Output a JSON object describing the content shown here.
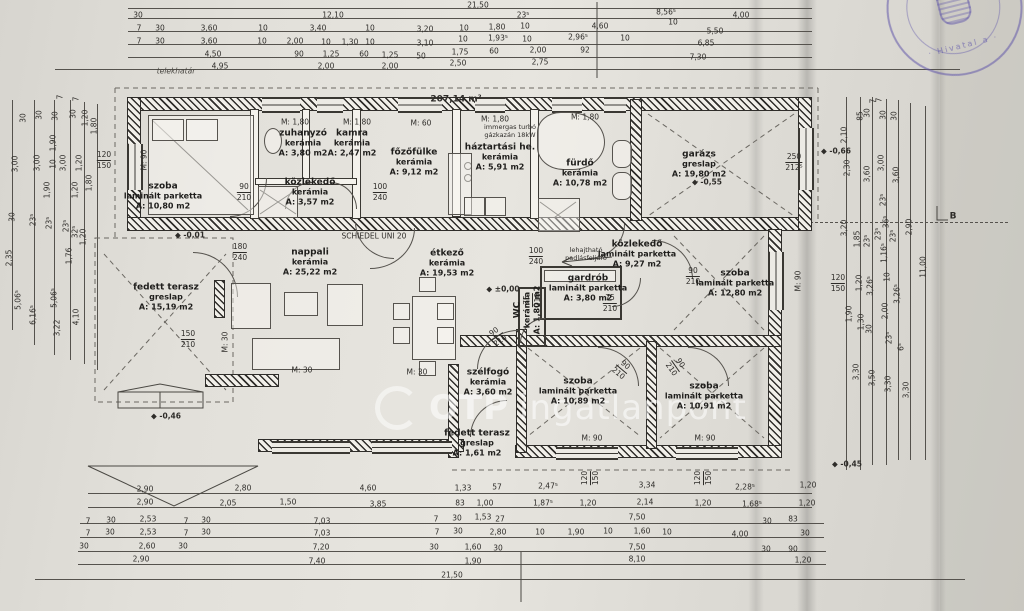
{
  "watermark": {
    "prefix": "OTP",
    "text": "ingatlanpont"
  },
  "stamp": {
    "text": "· Hivatal a ·"
  },
  "rooms": [
    {
      "name": "szoba",
      "material": "laminált parketta",
      "area": "A: 10,80 m2",
      "x": 163,
      "y": 196
    },
    {
      "name": "zuhanyzó",
      "material": "kerámia",
      "area": "A: 3,80 m2",
      "x": 303,
      "y": 143
    },
    {
      "name": "kamra",
      "material": "kerámia",
      "area": "A: 2,47 m2",
      "x": 352,
      "y": 143
    },
    {
      "name": "főzőfülke",
      "material": "kerámia",
      "area": "A: 9,12 m2",
      "x": 414,
      "y": 162
    },
    {
      "name": "háztartási he.",
      "material": "kerámia",
      "area": "A: 5,91 m2",
      "x": 500,
      "y": 157
    },
    {
      "name": "fürdő",
      "material": "kerámia",
      "area": "A: 10,78 m2",
      "x": 580,
      "y": 173
    },
    {
      "name": "garázs",
      "material": "greslap",
      "area": "A: 19,80 m2",
      "x": 699,
      "y": 164
    },
    {
      "name": "közlekedő",
      "material": "kerámia",
      "area": "A: 3,57 m2",
      "x": 310,
      "y": 192
    },
    {
      "name": "nappali",
      "material": "kerámia",
      "area": "A: 25,22 m2",
      "x": 310,
      "y": 262
    },
    {
      "name": "fedett terasz",
      "material": "greslap",
      "area": "A: 15,19 m2",
      "x": 166,
      "y": 297
    },
    {
      "name": "étkező",
      "material": "kerámia",
      "area": "A: 19,53 m2",
      "x": 447,
      "y": 263
    },
    {
      "name": "közlekedő",
      "material": "laminált parketta",
      "area": "A: 9,27 m2",
      "x": 637,
      "y": 254
    },
    {
      "name": "gardrób",
      "material": "laminált parketta",
      "area": "A: 3,80 m2",
      "x": 588,
      "y": 288
    },
    {
      "name": "WC",
      "material": "kerámia",
      "area": "A: 1,80 m2",
      "x": 527,
      "y": 310,
      "r": -90
    },
    {
      "name": "szoba",
      "material": "laminált parketta",
      "area": "A: 12,80 m2",
      "x": 735,
      "y": 283
    },
    {
      "name": "szoba",
      "material": "laminált parketta",
      "area": "A: 10,89 m2",
      "x": 578,
      "y": 391
    },
    {
      "name": "szoba",
      "material": "laminált parketta",
      "area": "A: 10,91 m2",
      "x": 704,
      "y": 396
    },
    {
      "name": "szélfogó",
      "material": "kerámia",
      "area": "A: 3,60 m2",
      "x": 488,
      "y": 382
    },
    {
      "name": "fedett terasz",
      "material": "greslap",
      "area": "A: 1,61 m2",
      "x": 477,
      "y": 443
    }
  ],
  "labels": [
    {
      "t": "21,50",
      "x": 478,
      "y": 5
    },
    {
      "t": "30",
      "x": 138,
      "y": 15
    },
    {
      "t": "12,10",
      "x": 333,
      "y": 15
    },
    {
      "t": "23⁵",
      "x": 523,
      "y": 15
    },
    {
      "t": "8,56⁵",
      "x": 666,
      "y": 12
    },
    {
      "t": "4,00",
      "x": 741,
      "y": 15
    },
    {
      "t": "7",
      "x": 139,
      "y": 28
    },
    {
      "t": "30",
      "x": 160,
      "y": 28
    },
    {
      "t": "3,60",
      "x": 209,
      "y": 28
    },
    {
      "t": "10",
      "x": 263,
      "y": 28
    },
    {
      "t": "3,40",
      "x": 318,
      "y": 28
    },
    {
      "t": "10",
      "x": 370,
      "y": 28
    },
    {
      "t": "3,20",
      "x": 425,
      "y": 29
    },
    {
      "t": "10",
      "x": 464,
      "y": 28
    },
    {
      "t": "1,80",
      "x": 497,
      "y": 27
    },
    {
      "t": "10",
      "x": 525,
      "y": 26
    },
    {
      "t": "4,60",
      "x": 600,
      "y": 26
    },
    {
      "t": "10",
      "x": 673,
      "y": 22
    },
    {
      "t": "5,50",
      "x": 715,
      "y": 31
    },
    {
      "t": "7",
      "x": 139,
      "y": 41
    },
    {
      "t": "30",
      "x": 160,
      "y": 41
    },
    {
      "t": "3,60",
      "x": 209,
      "y": 41
    },
    {
      "t": "10",
      "x": 262,
      "y": 41
    },
    {
      "t": "2,00",
      "x": 295,
      "y": 41
    },
    {
      "t": "10",
      "x": 326,
      "y": 42
    },
    {
      "t": "1,30",
      "x": 350,
      "y": 42
    },
    {
      "t": "10",
      "x": 370,
      "y": 42
    },
    {
      "t": "3,10",
      "x": 425,
      "y": 43
    },
    {
      "t": "10",
      "x": 463,
      "y": 39
    },
    {
      "t": "1,93⁵",
      "x": 498,
      "y": 38
    },
    {
      "t": "10",
      "x": 527,
      "y": 39
    },
    {
      "t": "2,96⁵",
      "x": 578,
      "y": 37
    },
    {
      "t": "10",
      "x": 625,
      "y": 38
    },
    {
      "t": "6,85",
      "x": 706,
      "y": 43
    },
    {
      "t": "4,50",
      "x": 213,
      "y": 54
    },
    {
      "t": "90",
      "x": 299,
      "y": 54
    },
    {
      "t": "1,25",
      "x": 331,
      "y": 54
    },
    {
      "t": "60",
      "x": 364,
      "y": 54
    },
    {
      "t": "1,25",
      "x": 390,
      "y": 55
    },
    {
      "t": "50",
      "x": 421,
      "y": 56
    },
    {
      "t": "1,75",
      "x": 460,
      "y": 52
    },
    {
      "t": "60",
      "x": 494,
      "y": 51
    },
    {
      "t": "2,00",
      "x": 538,
      "y": 50
    },
    {
      "t": "92",
      "x": 585,
      "y": 50
    },
    {
      "t": "7,30",
      "x": 698,
      "y": 57
    },
    {
      "t": "4,95",
      "x": 220,
      "y": 66
    },
    {
      "t": "2,00",
      "x": 326,
      "y": 66
    },
    {
      "t": "2,00",
      "x": 390,
      "y": 66
    },
    {
      "t": "2,50",
      "x": 458,
      "y": 63
    },
    {
      "t": "2,75",
      "x": 540,
      "y": 62
    },
    {
      "t": "telekhatár",
      "x": 176,
      "y": 71,
      "c": "it"
    },
    {
      "t": "207,14 m²",
      "x": 456,
      "y": 100,
      "c": "b"
    },
    {
      "t": "SCHIEDEL UNI 20",
      "x": 374,
      "y": 236
    },
    {
      "t": "immergas turbó",
      "x": 510,
      "y": 127,
      "c": "sm"
    },
    {
      "t": "gázkazán 18kW",
      "x": 510,
      "y": 135,
      "c": "sm"
    },
    {
      "t": "lehajtható",
      "x": 586,
      "y": 250,
      "c": "sm"
    },
    {
      "t": "padlásfeljáró",
      "x": 586,
      "y": 258,
      "c": "sm"
    },
    {
      "t": "B",
      "x": 953,
      "y": 217,
      "c": "b"
    },
    {
      "t": "±0,00",
      "x": 503,
      "y": 289,
      "c": "lvl"
    },
    {
      "t": "-0,01",
      "x": 190,
      "y": 235,
      "c": "lvl"
    },
    {
      "t": "-0,46",
      "x": 166,
      "y": 416,
      "c": "lvl"
    },
    {
      "t": "-0,45",
      "x": 847,
      "y": 464,
      "c": "lvl"
    },
    {
      "t": "-0,55",
      "x": 707,
      "y": 182,
      "c": "lvl"
    },
    {
      "t": "-0,66",
      "x": 836,
      "y": 151,
      "c": "lvl"
    },
    {
      "t": "M: 1,80",
      "x": 295,
      "y": 122
    },
    {
      "t": "M: 1,80",
      "x": 357,
      "y": 122
    },
    {
      "t": "M: 1,80",
      "x": 495,
      "y": 119
    },
    {
      "t": "M: 1,80",
      "x": 585,
      "y": 117
    },
    {
      "t": "M:  60",
      "x": 421,
      "y": 123
    },
    {
      "t": "M: 90",
      "x": 144,
      "y": 160,
      "r": -90
    },
    {
      "t": "M: 90",
      "x": 798,
      "y": 281,
      "r": -90
    },
    {
      "t": "M: 90",
      "x": 592,
      "y": 438
    },
    {
      "t": "M: 90",
      "x": 705,
      "y": 438
    },
    {
      "t": "M: 30",
      "x": 302,
      "y": 370
    },
    {
      "t": "M: 30",
      "x": 417,
      "y": 372
    },
    {
      "t": "M: 30",
      "x": 225,
      "y": 342,
      "r": -90
    },
    {
      "f": [
        "90",
        "210"
      ],
      "x": 244,
      "y": 192
    },
    {
      "f": [
        "100",
        "240"
      ],
      "x": 380,
      "y": 192
    },
    {
      "f": [
        "100",
        "240"
      ],
      "x": 536,
      "y": 256
    },
    {
      "f": [
        "75",
        "210"
      ],
      "x": 610,
      "y": 303
    },
    {
      "f": [
        "75",
        "210"
      ],
      "x": 532,
      "y": 300,
      "r": -90
    },
    {
      "f": [
        "90",
        "210"
      ],
      "x": 693,
      "y": 276
    },
    {
      "f": [
        "150",
        "210"
      ],
      "x": 188,
      "y": 339
    },
    {
      "f": [
        "180",
        "240"
      ],
      "x": 240,
      "y": 252
    },
    {
      "f": [
        "90",
        "210"
      ],
      "x": 497,
      "y": 336,
      "r": -35
    },
    {
      "f": [
        "90",
        "210"
      ],
      "x": 622,
      "y": 369,
      "r": 40
    },
    {
      "f": [
        "90",
        "210"
      ],
      "x": 676,
      "y": 366,
      "r": 55
    },
    {
      "f": [
        "250",
        "212⁵"
      ],
      "x": 794,
      "y": 162
    },
    {
      "f": [
        "120",
        "150"
      ],
      "x": 104,
      "y": 160
    },
    {
      "f": [
        "120",
        "150"
      ],
      "x": 838,
      "y": 283
    },
    {
      "f": [
        "120",
        "150"
      ],
      "x": 590,
      "y": 478,
      "r": -90
    },
    {
      "f": [
        "120",
        "150"
      ],
      "x": 703,
      "y": 478,
      "r": -90
    },
    {
      "t": "2,90",
      "x": 145,
      "y": 489
    },
    {
      "t": "2,80",
      "x": 243,
      "y": 488
    },
    {
      "t": "4,60",
      "x": 368,
      "y": 488
    },
    {
      "t": "1,33",
      "x": 463,
      "y": 488
    },
    {
      "t": "57",
      "x": 497,
      "y": 487
    },
    {
      "t": "2,47⁵",
      "x": 548,
      "y": 486
    },
    {
      "t": "3,34",
      "x": 647,
      "y": 485
    },
    {
      "t": "2,28⁵",
      "x": 745,
      "y": 487
    },
    {
      "t": "1,20",
      "x": 808,
      "y": 485
    },
    {
      "t": "2,90",
      "x": 145,
      "y": 502
    },
    {
      "t": "2,05",
      "x": 228,
      "y": 503
    },
    {
      "t": "1,50",
      "x": 288,
      "y": 502
    },
    {
      "t": "3,85",
      "x": 378,
      "y": 504
    },
    {
      "t": "83",
      "x": 460,
      "y": 503
    },
    {
      "t": "1,00",
      "x": 485,
      "y": 503
    },
    {
      "t": "1,87⁵",
      "x": 543,
      "y": 503
    },
    {
      "t": "1,20",
      "x": 588,
      "y": 503
    },
    {
      "t": "2,14",
      "x": 645,
      "y": 502
    },
    {
      "t": "1,20",
      "x": 703,
      "y": 503
    },
    {
      "t": "1,68⁵",
      "x": 752,
      "y": 504
    },
    {
      "t": "1,20",
      "x": 807,
      "y": 503
    },
    {
      "t": "7",
      "x": 88,
      "y": 521
    },
    {
      "t": "30",
      "x": 111,
      "y": 520
    },
    {
      "t": "2,53",
      "x": 148,
      "y": 519
    },
    {
      "t": "7",
      "x": 186,
      "y": 521
    },
    {
      "t": "30",
      "x": 206,
      "y": 520
    },
    {
      "t": "7,03",
      "x": 322,
      "y": 521
    },
    {
      "t": "7",
      "x": 436,
      "y": 519
    },
    {
      "t": "30",
      "x": 457,
      "y": 518
    },
    {
      "t": "1,53",
      "x": 483,
      "y": 517
    },
    {
      "t": "27",
      "x": 500,
      "y": 519
    },
    {
      "t": "7,50",
      "x": 637,
      "y": 517
    },
    {
      "t": "30",
      "x": 767,
      "y": 521
    },
    {
      "t": "83",
      "x": 793,
      "y": 519
    },
    {
      "t": "7",
      "x": 88,
      "y": 533
    },
    {
      "t": "30",
      "x": 110,
      "y": 532
    },
    {
      "t": "2,53",
      "x": 148,
      "y": 532
    },
    {
      "t": "7",
      "x": 186,
      "y": 533
    },
    {
      "t": "30",
      "x": 206,
      "y": 532
    },
    {
      "t": "7,03",
      "x": 322,
      "y": 533
    },
    {
      "t": "7",
      "x": 437,
      "y": 532
    },
    {
      "t": "30",
      "x": 458,
      "y": 531
    },
    {
      "t": "2,80",
      "x": 498,
      "y": 532
    },
    {
      "t": "10",
      "x": 540,
      "y": 532
    },
    {
      "t": "1,90",
      "x": 576,
      "y": 532
    },
    {
      "t": "10",
      "x": 608,
      "y": 531
    },
    {
      "t": "1,60",
      "x": 642,
      "y": 531
    },
    {
      "t": "10",
      "x": 667,
      "y": 532
    },
    {
      "t": "4,00",
      "x": 740,
      "y": 534
    },
    {
      "t": "30",
      "x": 805,
      "y": 533
    },
    {
      "t": "30",
      "x": 84,
      "y": 546
    },
    {
      "t": "2,60",
      "x": 147,
      "y": 546
    },
    {
      "t": "30",
      "x": 183,
      "y": 546
    },
    {
      "t": "7,20",
      "x": 321,
      "y": 547
    },
    {
      "t": "30",
      "x": 434,
      "y": 547
    },
    {
      "t": "1,60",
      "x": 473,
      "y": 547
    },
    {
      "t": "30",
      "x": 498,
      "y": 548
    },
    {
      "t": "7,50",
      "x": 637,
      "y": 547
    },
    {
      "t": "30",
      "x": 766,
      "y": 549
    },
    {
      "t": "90",
      "x": 793,
      "y": 549
    },
    {
      "t": "2,90",
      "x": 141,
      "y": 559
    },
    {
      "t": "7,40",
      "x": 317,
      "y": 561
    },
    {
      "t": "1,90",
      "x": 473,
      "y": 561
    },
    {
      "t": "8,10",
      "x": 637,
      "y": 559
    },
    {
      "t": "1,20",
      "x": 803,
      "y": 560
    },
    {
      "t": "21,50",
      "x": 452,
      "y": 575
    },
    {
      "t": "30",
      "x": 23,
      "y": 118,
      "r": -90
    },
    {
      "t": "30",
      "x": 39,
      "y": 115,
      "r": -90
    },
    {
      "t": "30",
      "x": 55,
      "y": 116,
      "r": -90
    },
    {
      "t": "30",
      "x": 73,
      "y": 114,
      "r": -90
    },
    {
      "t": "7",
      "x": 60,
      "y": 97,
      "r": -90
    },
    {
      "t": "7",
      "x": 76,
      "y": 99,
      "r": -90
    },
    {
      "t": "1,20",
      "x": 85,
      "y": 118,
      "r": -90
    },
    {
      "t": "1,80",
      "x": 94,
      "y": 126,
      "r": -90
    },
    {
      "t": "1,90",
      "x": 53,
      "y": 143,
      "r": -90
    },
    {
      "t": "3,00",
      "x": 15,
      "y": 164,
      "r": -90
    },
    {
      "t": "3,00",
      "x": 37,
      "y": 163,
      "r": -90
    },
    {
      "t": "10",
      "x": 53,
      "y": 164,
      "r": -90
    },
    {
      "t": "3,00",
      "x": 63,
      "y": 163,
      "r": -90
    },
    {
      "t": "1,20",
      "x": 79,
      "y": 163,
      "r": -90
    },
    {
      "t": "1,90",
      "x": 47,
      "y": 190,
      "r": -90
    },
    {
      "t": "1,20",
      "x": 75,
      "y": 190,
      "r": -90
    },
    {
      "t": "1,80",
      "x": 89,
      "y": 183,
      "r": -90
    },
    {
      "t": "30",
      "x": 12,
      "y": 217,
      "r": -90
    },
    {
      "t": "23⁵",
      "x": 33,
      "y": 220,
      "r": -90
    },
    {
      "t": "23⁵",
      "x": 49,
      "y": 223,
      "r": -90
    },
    {
      "t": "23⁵",
      "x": 66,
      "y": 226,
      "r": -90
    },
    {
      "t": "32⁵",
      "x": 75,
      "y": 232,
      "r": -90
    },
    {
      "t": "1,20",
      "x": 83,
      "y": 237,
      "r": -90
    },
    {
      "t": "2,35",
      "x": 9,
      "y": 258,
      "r": -90
    },
    {
      "t": "1,76",
      "x": 69,
      "y": 256,
      "r": -90
    },
    {
      "t": "5,06⁵",
      "x": 18,
      "y": 300,
      "r": -90
    },
    {
      "t": "6,16⁵",
      "x": 33,
      "y": 315,
      "r": -90
    },
    {
      "t": "5,06⁵",
      "x": 54,
      "y": 298,
      "r": -90
    },
    {
      "t": "4,10",
      "x": 76,
      "y": 317,
      "r": -90
    },
    {
      "t": "3,22",
      "x": 57,
      "y": 328,
      "r": -90
    },
    {
      "t": "85",
      "x": 860,
      "y": 116,
      "r": -90
    },
    {
      "t": "30",
      "x": 867,
      "y": 113,
      "r": -90
    },
    {
      "t": "7",
      "x": 873,
      "y": 101,
      "r": -90
    },
    {
      "t": "30",
      "x": 883,
      "y": 115,
      "r": -90
    },
    {
      "t": "7",
      "x": 879,
      "y": 100,
      "r": -90
    },
    {
      "t": "30",
      "x": 894,
      "y": 116,
      "r": -90
    },
    {
      "t": "2,10",
      "x": 844,
      "y": 135,
      "r": -90
    },
    {
      "t": "2,30",
      "x": 847,
      "y": 168,
      "r": -90
    },
    {
      "t": "3,60",
      "x": 867,
      "y": 174,
      "r": -90
    },
    {
      "t": "3,00",
      "x": 881,
      "y": 163,
      "r": -90
    },
    {
      "t": "3,60",
      "x": 896,
      "y": 175,
      "r": -90
    },
    {
      "t": "23⁵",
      "x": 883,
      "y": 200,
      "r": -90
    },
    {
      "t": "3,20",
      "x": 844,
      "y": 228,
      "r": -90
    },
    {
      "t": "1,85",
      "x": 857,
      "y": 239,
      "r": -90
    },
    {
      "t": "23⁵",
      "x": 867,
      "y": 241,
      "r": -90
    },
    {
      "t": "36⁵",
      "x": 886,
      "y": 222,
      "r": -90
    },
    {
      "t": "23⁵",
      "x": 878,
      "y": 234,
      "r": -90
    },
    {
      "t": "1,16⁵",
      "x": 884,
      "y": 253,
      "r": -90
    },
    {
      "t": "23⁵",
      "x": 893,
      "y": 236,
      "r": -90
    },
    {
      "t": "2,90",
      "x": 909,
      "y": 227,
      "r": -90
    },
    {
      "t": "1,20",
      "x": 859,
      "y": 283,
      "r": -90
    },
    {
      "t": "3,26⁵",
      "x": 870,
      "y": 286,
      "r": -90
    },
    {
      "t": "10",
      "x": 887,
      "y": 277,
      "r": -90
    },
    {
      "t": "3,26⁵",
      "x": 897,
      "y": 294,
      "r": -90
    },
    {
      "t": "11,00",
      "x": 923,
      "y": 267,
      "r": -90
    },
    {
      "t": "1,90",
      "x": 849,
      "y": 314,
      "r": -90
    },
    {
      "t": "1,30",
      "x": 861,
      "y": 322,
      "r": -90
    },
    {
      "t": "30",
      "x": 869,
      "y": 329,
      "r": -90
    },
    {
      "t": "2,00",
      "x": 885,
      "y": 311,
      "r": -90
    },
    {
      "t": "23⁵",
      "x": 889,
      "y": 338,
      "r": -90
    },
    {
      "t": "6⁵",
      "x": 901,
      "y": 347,
      "r": -90
    },
    {
      "t": "3,30",
      "x": 856,
      "y": 372,
      "r": -90
    },
    {
      "t": "3,50",
      "x": 872,
      "y": 378,
      "r": -90
    },
    {
      "t": "3,30",
      "x": 888,
      "y": 384,
      "r": -90
    },
    {
      "t": "3,30",
      "x": 906,
      "y": 390,
      "r": -90
    }
  ]
}
